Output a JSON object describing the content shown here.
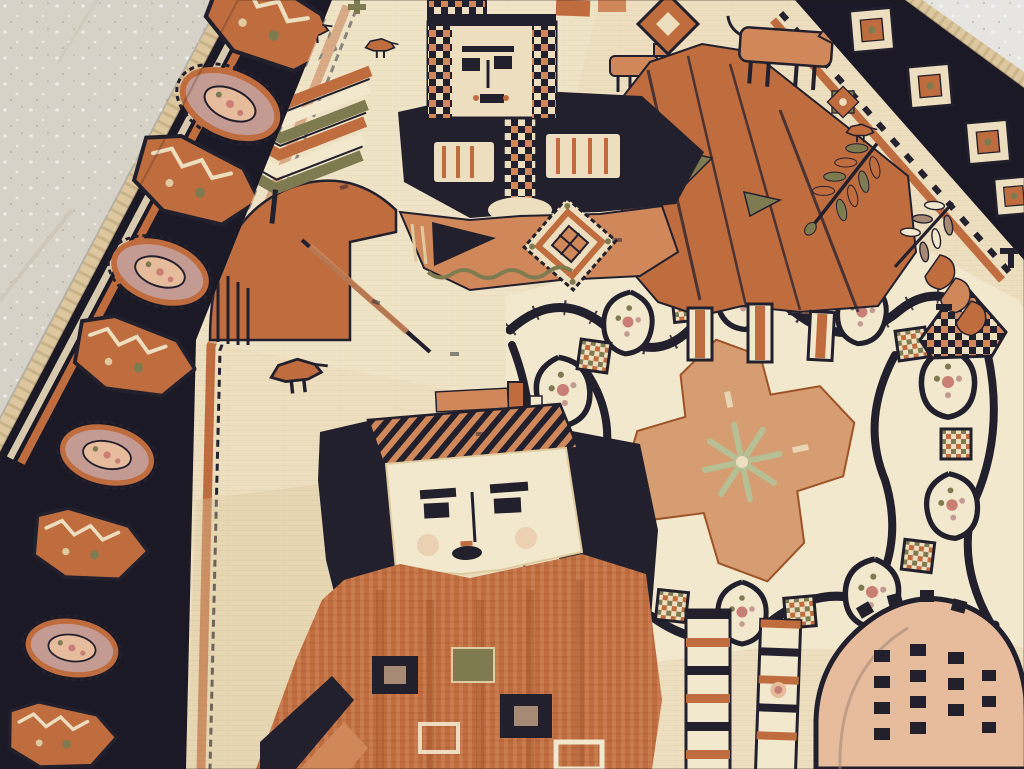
{
  "scene": {
    "description": "Close-up photograph of a handwoven antique Persian pictorial tribal rug lying on a light speckled terrazzo floor, viewed at a steep angle from one end",
    "aria_label": "Antique pictorial tribal rug on a terrazzo floor",
    "floor": "light gray-beige terrazzo with white and dark speckles, visible in the top-left and top-right corners",
    "rug_ground": "ivory-cream wool field with rust-orange, charcoal-navy, olive and pink motifs"
  },
  "palette": {
    "floorA": "#d6d2c7",
    "floorB": "#e6e5e1",
    "floorSeam": "#cbc6b9",
    "fringe": "#ddc79e",
    "night": "#1c1926",
    "ink": "#23202e",
    "navy": "#2e2a3d",
    "rust": "#bf6c3e",
    "rustDeep": "#9e5227",
    "rustLight": "#d0885a",
    "salmon": "#d79d72",
    "blush": "#e6bc9d",
    "cream": "#ecdebe",
    "creamDeep": "#dfcb9f",
    "parchment": "#f2e8cd",
    "olive": "#7f7b51",
    "mauve": "#c49b92",
    "pink": "#c97f76",
    "taupe": "#a68a76",
    "paleGreen": "#b7bf95"
  },
  "motifs": {
    "left_border": "dark navy main border with alternating serrated orange leaf-boats and mauve oval rosettes, cream and rust guard stripes, knotted fringe edge",
    "right_border": "partially visible navy border with cream diamond rosettes at the top-right corner",
    "tree": "chevron herringbone tree with an eight-point star finial and small birds",
    "hill": "rust mound with diagonal ray stripes and a striped skirt",
    "rider_figure": "figure with checkered head block, dark navy torso with cream windows, and an orange saddle panel bearing a serrated diamond medallion and a dark triangle",
    "canopy": "large rust-orange mass with olive triangles, dark slant lines and bar-shaped legs",
    "horse": "small rust horse with dark legs near an orange eight-point star and a tiny bird",
    "ferns": "olive and rust fern fronds and curved leaves along the right side",
    "lattice_panel": "cream panel with dark vine lattice, rosette cells, checkered junctions and a central salmon cross medallion with pale-green starburst",
    "front_figure": "large frontal figure: cream square face with dark brows, eyes, nose and mouth, striped hat, navy hair, rust striped gown with olive, navy and cream square amulets",
    "dome": "peach dome medallion with dashed dark columns at bottom right",
    "ladders": "cream ladder-like bars with alternating navy and rust rungs"
  }
}
